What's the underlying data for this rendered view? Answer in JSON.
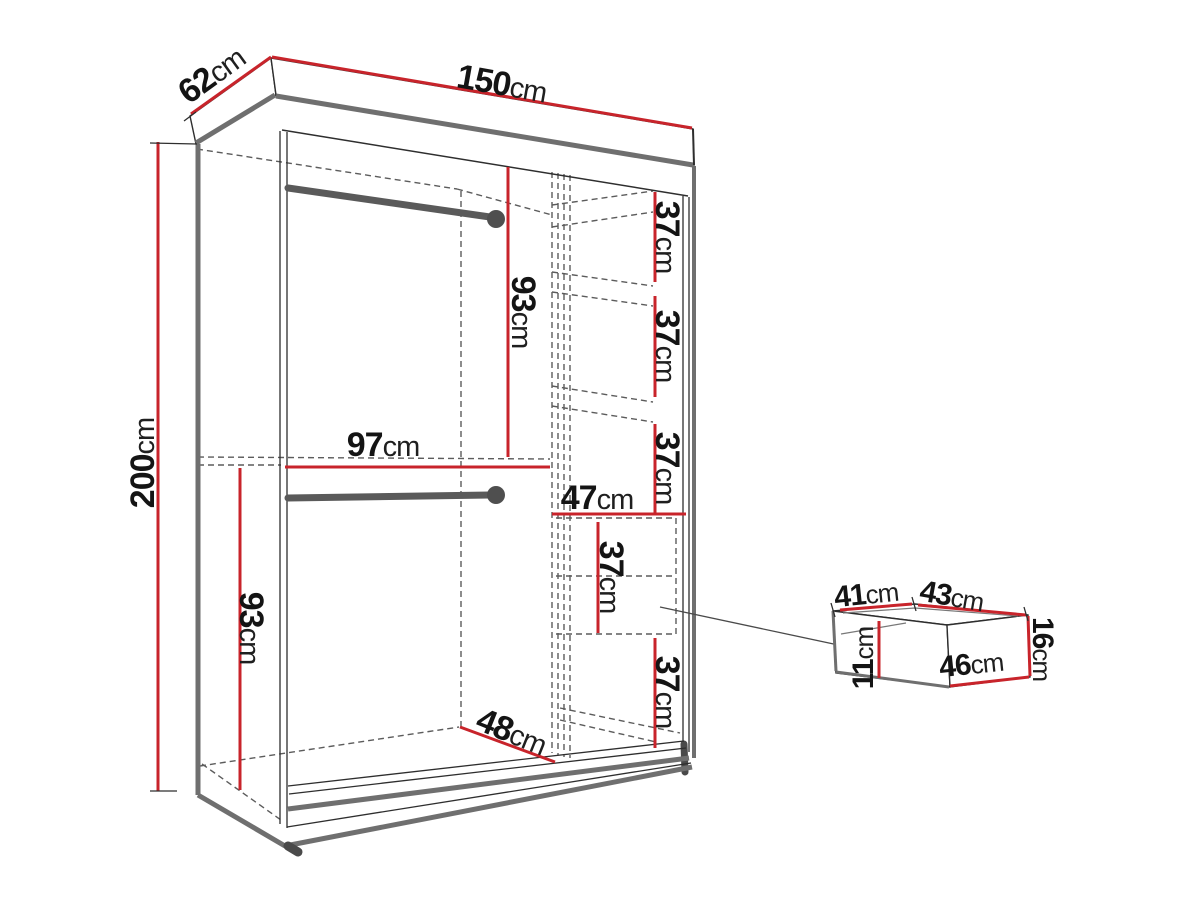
{
  "diagram_type": "wardrobe dimension drawing",
  "colors": {
    "dimension_line_red": "#c8242b",
    "structure_gray": "#6f6f6f",
    "outline_black": "#2e2e2e",
    "background": "#ffffff"
  },
  "wardrobe": {
    "depth_top": {
      "value": "62",
      "unit": "cm"
    },
    "width_top": {
      "value": "150",
      "unit": "cm"
    },
    "height_left": {
      "value": "200",
      "unit": "cm"
    },
    "upper_hanging_height": {
      "value": "93",
      "unit": "cm"
    },
    "open_section_width": {
      "value": "97",
      "unit": "cm"
    },
    "lower_hanging_height": {
      "value": "93",
      "unit": "cm"
    },
    "shelf_gap_1": {
      "value": "37",
      "unit": "cm"
    },
    "shelf_gap_2": {
      "value": "37",
      "unit": "cm"
    },
    "shelf_gap_3": {
      "value": "37",
      "unit": "cm"
    },
    "shelf_column_width": {
      "value": "47",
      "unit": "cm"
    },
    "drawer_compartment_height": {
      "value": "37",
      "unit": "cm"
    },
    "bottom_gap": {
      "value": "37",
      "unit": "cm"
    },
    "floor_depth": {
      "value": "48",
      "unit": "cm"
    }
  },
  "drawer": {
    "inner_width": {
      "value": "41",
      "unit": "cm"
    },
    "top_width": {
      "value": "43",
      "unit": "cm"
    },
    "front_height": {
      "value": "16",
      "unit": "cm"
    },
    "inner_height": {
      "value": "11",
      "unit": "cm"
    },
    "front_width": {
      "value": "46",
      "unit": "cm"
    }
  }
}
